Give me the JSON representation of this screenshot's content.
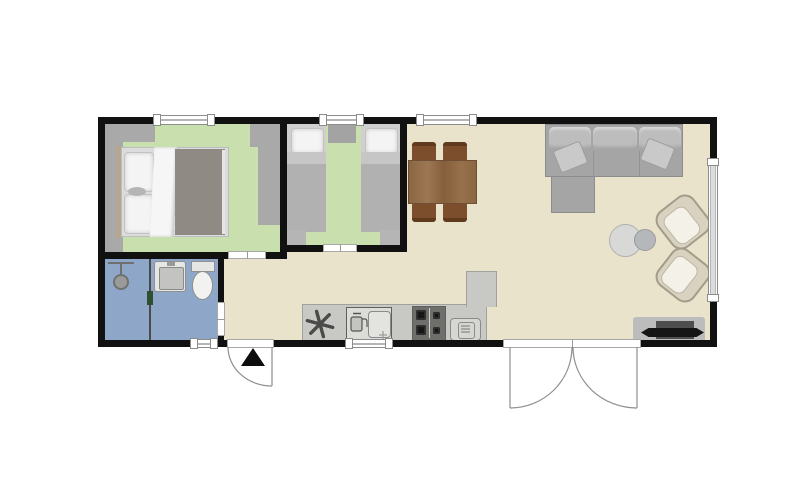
{
  "scene": {
    "type": "floor-plan",
    "description": "Top-down floor plan of a small single-storey holiday home with two bedrooms, bathroom and open-plan kitchen/living room",
    "entrance_marker": "up-triangle"
  },
  "rooms": [
    {
      "id": "bedroom-double",
      "floor": "green",
      "items": [
        "double-bed",
        "pillows",
        "wardrobe-strips"
      ]
    },
    {
      "id": "bedroom-twin",
      "floor": "green",
      "items": [
        "single-bed-left",
        "single-bed-right",
        "nightstand",
        "foot-rugs"
      ]
    },
    {
      "id": "bathroom",
      "floor": "blue",
      "items": [
        "shower",
        "shower-divider",
        "washbasin",
        "toilet"
      ]
    },
    {
      "id": "living-kitchen",
      "floor": "beige",
      "items": [
        "dining-table",
        "four-chairs",
        "corner-sofa",
        "chaise",
        "throw-pillows",
        "armchair-upper",
        "armchair-lower",
        "coffee-table-duo",
        "tv-stand",
        "kitchen-counter",
        "heater-fan-symbol",
        "kitchen-sink",
        "stove-4-burners",
        "microwave"
      ]
    }
  ],
  "openings": {
    "windows": [
      "top-bedroom-double",
      "top-bedroom-twin",
      "top-dining",
      "bottom-bathroom",
      "bottom-kitchen",
      "right-living"
    ],
    "doors": [
      "entrance-single-swing",
      "french-double-swing",
      "bedroom-double-door",
      "bedroom-twin-door",
      "bathroom-door"
    ]
  },
  "colors": {
    "wall": "#111111",
    "floor_living": "#eae3cb",
    "floor_bedroom": "#c9dfae",
    "floor_bath": "#8ea7c8",
    "wardrobe": "#a9a9a9",
    "rug": "#b5b5b5",
    "counter": "#c8c8c4",
    "counter_border": "#a0a09c",
    "table": "#8f6a45",
    "chair": "#7c4e2b",
    "sofa": "#a5a5a5",
    "sofa_back": "#bdbdbd",
    "sofa_border": "#8c8c8c",
    "armchair": "#d9d2c0",
    "armchair_cushion": "#f4f1e8",
    "coffee_large": "#d8d8d6",
    "coffee_small": "#b4b8ba",
    "tv_stand": "#bcbcbc",
    "tv_black": "#151515",
    "tv_dark": "#4e4e4e",
    "bed_duvet": "#8f8a84",
    "bed_duvet_light": "#b1b1b1",
    "pillow": "#f4f4f4",
    "mattress": "#dcdcdc",
    "headboard": "#b5a78f",
    "nightstand": "#a3a3a3",
    "fixture": "#e6e6e4",
    "fixture_border": "#909090",
    "window_frame": "#8c8c8c",
    "swing": "#8f8f8f",
    "appliance_face": "#dcdcd8",
    "appliance_border": "#5f5f5f",
    "burner": "#161616",
    "marker": "#0d0d0d",
    "hinge_green": "#2f4f2f",
    "divider": "#4a4a4a",
    "shower": "#9a9a9a"
  }
}
